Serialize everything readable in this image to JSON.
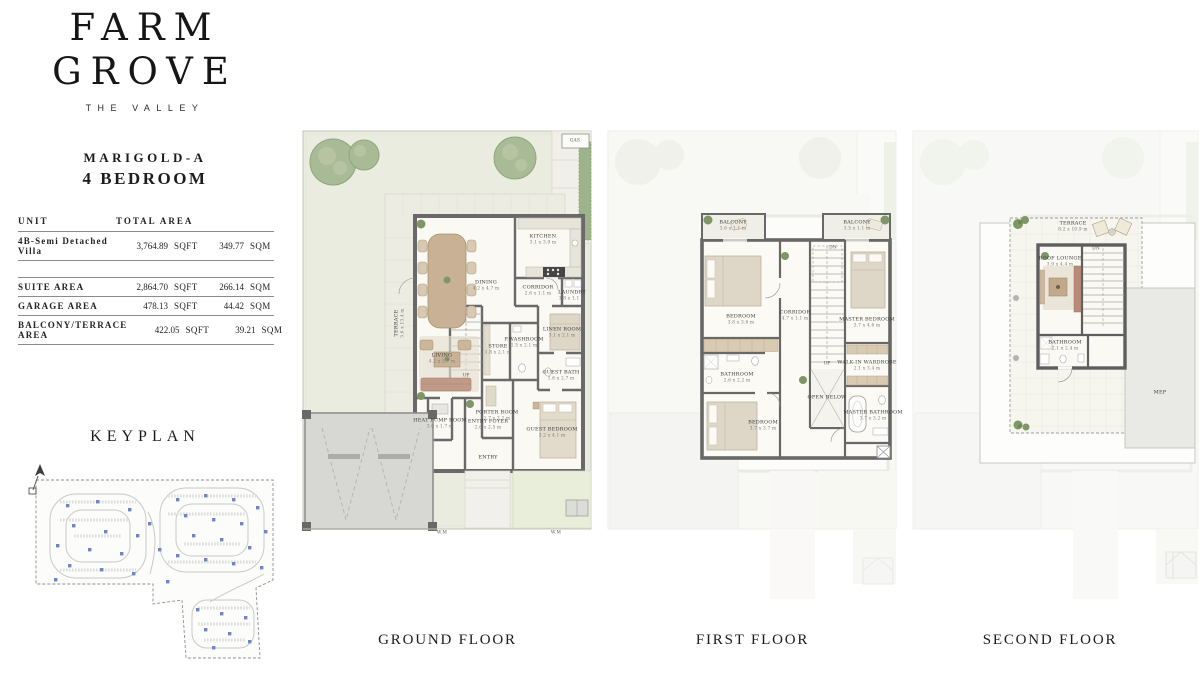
{
  "brand": {
    "name_line1": "FARM",
    "name_line2": "GROVE",
    "tagline": "THE VALLEY"
  },
  "unit": {
    "name": "MARIGOLD-A",
    "bedrooms": "4 BEDROOM"
  },
  "area_table": {
    "header": {
      "unit": "UNIT",
      "total": "TOTAL AREA"
    },
    "primary_row": {
      "label": "4B-Semi Detached Villa",
      "sqft": "3,764.89",
      "sqft_u": "SQFT",
      "sqm": "349.77",
      "sqm_u": "SQM"
    },
    "rows": [
      {
        "label": "SUITE AREA",
        "sqft": "2,864.70",
        "sqft_u": "SQFT",
        "sqm": "266.14",
        "sqm_u": "SQM"
      },
      {
        "label": "GARAGE AREA",
        "sqft": "478.13",
        "sqft_u": "SQFT",
        "sqm": "44.42",
        "sqm_u": "SQM"
      },
      {
        "label": "BALCONY/TERRACE AREA",
        "sqft": "422.05",
        "sqft_u": "SQFT",
        "sqm": "39.21",
        "sqm_u": "SQM"
      }
    ]
  },
  "keyplan": {
    "title": "KEYPLAN",
    "marker_color": "#6d87c5"
  },
  "annotations": {
    "gas": "GAS",
    "wm": "W.M",
    "up": "UP",
    "dn": "DN"
  },
  "colors": {
    "garden": "#e9ecdf",
    "wall": "#696969",
    "paving": "#edece3",
    "garage": "#d7d7d4",
    "tree": "#a9ba97",
    "hedge": "#9db38a",
    "wood": "#c9b196",
    "ghost": "#f3f4ee"
  },
  "floors": [
    {
      "caption": "GROUND FLOOR",
      "rooms": [
        {
          "name": "TERRACE",
          "dims": "3.6 x 13.4 m"
        },
        {
          "name": "DINING",
          "dims": "4.2 x 4.7 m"
        },
        {
          "name": "KITCHEN",
          "dims": "3.1 x 3.9 m"
        },
        {
          "name": "CORRIDOR",
          "dims": "2.6 x 1.1 m"
        },
        {
          "name": "LAUNDRY",
          "dims": "1.8 x 1.1 m"
        },
        {
          "name": "STORE",
          "dims": "1.8 x 2.1 m"
        },
        {
          "name": "P.WASHROOM",
          "dims": "1.5 x 2.1 m"
        },
        {
          "name": "LINEN ROOM",
          "dims": "3.1 x 2.1 m"
        },
        {
          "name": "LIVING",
          "dims": "4.2 x 5.7 m"
        },
        {
          "name": "PORTER ROOM",
          "dims": "1.7 x 2.2 m"
        },
        {
          "name": "GUEST BATH",
          "dims": "1.6 x 2.7 m"
        },
        {
          "name": "HEAT PUMP ROOM",
          "dims": "3.0 x 1.7 m"
        },
        {
          "name": "ENTRY FOYER",
          "dims": "2.6 x 2.5 m"
        },
        {
          "name": "ENTRY",
          "dims": ""
        },
        {
          "name": "GUEST BEDROOM",
          "dims": "3.2 x 4.1 m"
        }
      ]
    },
    {
      "caption": "FIRST FLOOR",
      "rooms": [
        {
          "name": "BALCONY",
          "dims": "3.6 x 1.1 m"
        },
        {
          "name": "BEDROOM",
          "dims": "3.8 x 3.6 m"
        },
        {
          "name": "CORRIDOR",
          "dims": "4.7 x 1.1 m"
        },
        {
          "name": "BALCONY",
          "dims": "3.5 x 1.1 m"
        },
        {
          "name": "MASTER BEDROOM",
          "dims": "3.7 x 4.6 m"
        },
        {
          "name": "BATHROOM",
          "dims": "2.6 x 2.2 m"
        },
        {
          "name": "BEDROOM",
          "dims": "3.7 x 3.7 m"
        },
        {
          "name": "OPEN BELOW",
          "dims": ""
        },
        {
          "name": "WALK-IN WARDROBE",
          "dims": "2.1 x 3.4 m"
        },
        {
          "name": "MASTER BATHROOM",
          "dims": "3.7 x 3.2 m"
        }
      ]
    },
    {
      "caption": "SECOND FLOOR",
      "rooms": [
        {
          "name": "TERRACE",
          "dims": "8.2 x 10.9 m"
        },
        {
          "name": "ROOF LOUNGE",
          "dims": "3.9 x 4.4 m"
        },
        {
          "name": "BATHROOM",
          "dims": "2.1 x 2.4 m"
        },
        {
          "name": "MEP",
          "dims": ""
        }
      ]
    }
  ]
}
